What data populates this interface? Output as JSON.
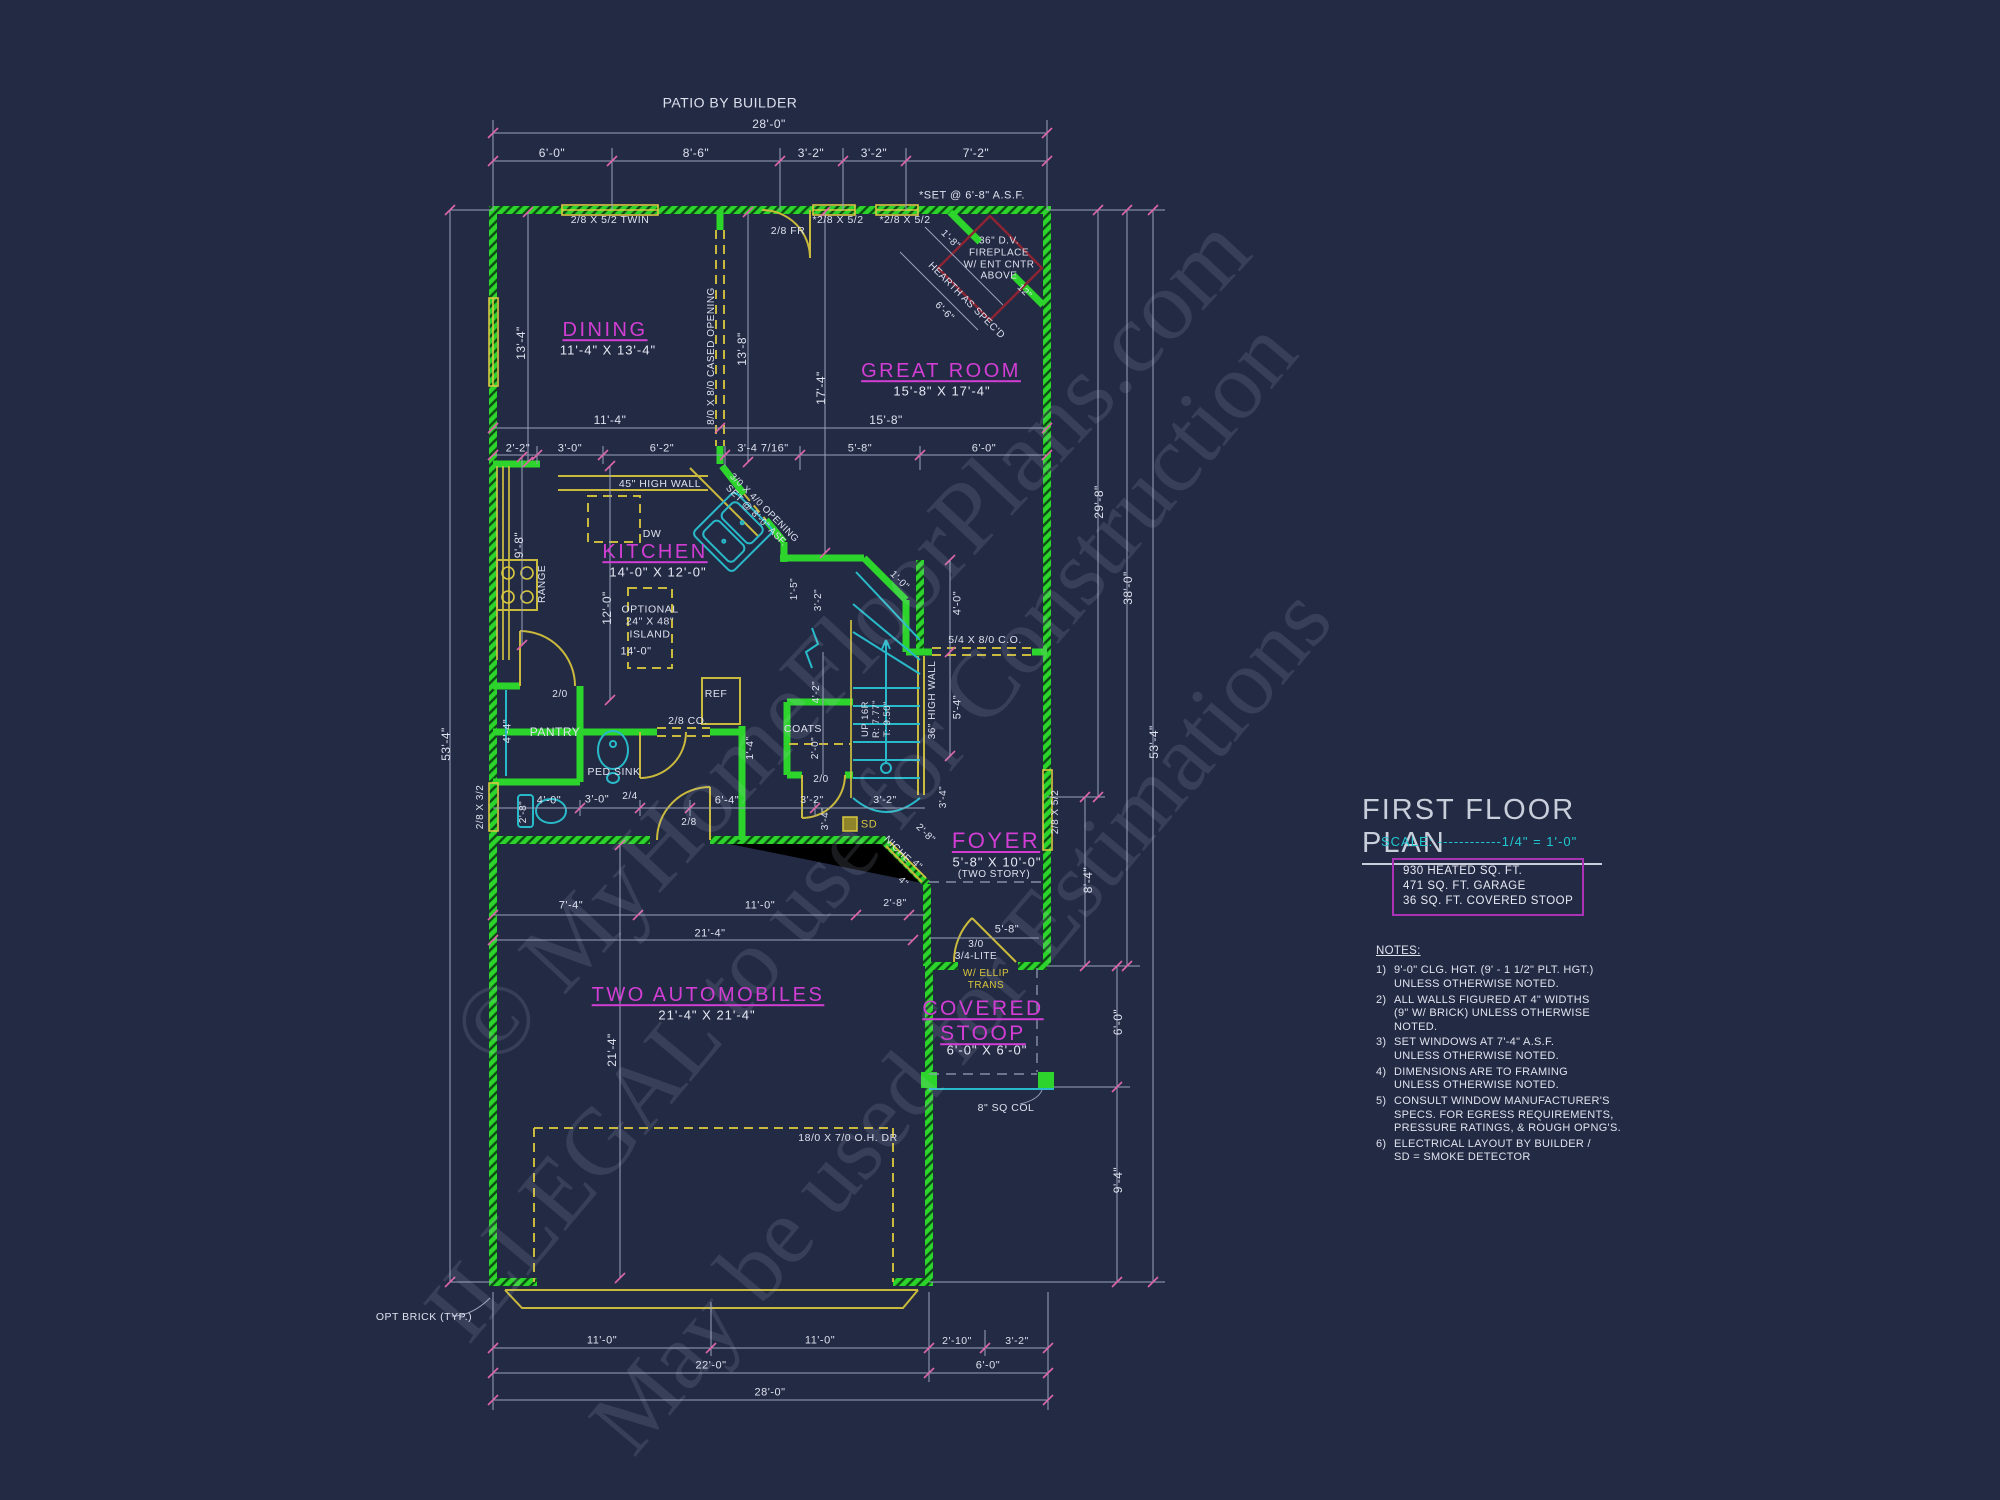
{
  "title_block": {
    "title": "FIRST FLOOR PLAN",
    "scale_text": "SCALE: ------------1/4\" = 1'-0\"",
    "area_lines": [
      "930 HEATED SQ. FT.",
      "471 SQ. FT. GARAGE",
      "36 SQ. FT. COVERED STOOP"
    ]
  },
  "notes": {
    "heading": "NOTES:",
    "items": [
      {
        "num": "1)",
        "text": "9'-0\"  CLG. HGT. (9' - 1 1/2\" PLT. HGT.)\nUNLESS OTHERWISE NOTED."
      },
      {
        "num": "2)",
        "text": "ALL  WALLS FIGURED AT 4\" WIDTHS\n(9\" W/ BRICK) UNLESS OTHERWISE NOTED."
      },
      {
        "num": "3)",
        "text": "SET WINDOWS AT 7'-4\" A.S.F.\nUNLESS OTHERWISE NOTED."
      },
      {
        "num": "4)",
        "text": "DIMENSIONS ARE TO FRAMING\nUNLESS OTHERWISE NOTED."
      },
      {
        "num": "5)",
        "text": "CONSULT WINDOW MANUFACTURER'S\nSPECS. FOR EGRESS REQUIREMENTS,\nPRESSURE RATINGS, & ROUGH OPNG'S."
      },
      {
        "num": "6)",
        "text": "ELECTRICAL LAYOUT BY BUILDER /\nSD = SMOKE DETECTOR"
      }
    ]
  },
  "watermark": {
    "lines": [
      {
        "t": "© MyHomeFloorPlans.com",
        "x": 850,
        "y": 640,
        "r": -47,
        "fs": 100
      },
      {
        "t": "ILLEGAL to use for Construction",
        "x": 860,
        "y": 830,
        "r": -50,
        "fs": 95
      },
      {
        "t": "May be used for Estimations",
        "x": 960,
        "y": 1020,
        "r": -50,
        "fs": 95
      }
    ]
  },
  "colors": {
    "background": "#232a44",
    "walls": "#2cd42c",
    "millwork": "#c9b93c",
    "fixtures": "#29bac9",
    "rooms": "#d23ed4",
    "dims": "#dde1ee",
    "ticks": "#de66a6",
    "scale": "#1fc9d2",
    "area_box_border": "#ab32b5",
    "fireplace": "#8c2433"
  },
  "plan": {
    "labels": [
      {
        "t": "PATIO BY BUILDER",
        "x": 730,
        "y": 103,
        "c": "dim",
        "fs": 14
      },
      {
        "t": "28'-0\"",
        "x": 769,
        "y": 124,
        "c": "dim"
      },
      {
        "t": "6'-0\"",
        "x": 552,
        "y": 153,
        "c": "dim"
      },
      {
        "t": "8'-6\"",
        "x": 696,
        "y": 153,
        "c": "dim"
      },
      {
        "t": "3'-2\"",
        "x": 811,
        "y": 153,
        "c": "dim"
      },
      {
        "t": "3'-2\"",
        "x": 874,
        "y": 153,
        "c": "dim"
      },
      {
        "t": "7'-2\"",
        "x": 976,
        "y": 153,
        "c": "dim"
      },
      {
        "t": "*SET @ 6'-8\" A.S.F.",
        "x": 972,
        "y": 196,
        "c": "dim",
        "fs": 11
      },
      {
        "t": "2/8 X 5/2 TWIN",
        "x": 610,
        "y": 220,
        "c": "dim",
        "fs": 10.5
      },
      {
        "t": "*2/8 X 5/2",
        "x": 838,
        "y": 220,
        "c": "dim",
        "fs": 10.5
      },
      {
        "t": "*2/8 X 5/2",
        "x": 905,
        "y": 220,
        "c": "dim",
        "fs": 10.5
      },
      {
        "t": "2/8 FR",
        "x": 788,
        "y": 231,
        "c": "dim",
        "fs": 10.5
      },
      {
        "t": "DINING",
        "x": 605,
        "y": 331,
        "c": "room"
      },
      {
        "t": "11'-4\" X 13'-4\"",
        "x": 608,
        "y": 350,
        "c": "rdim"
      },
      {
        "t": "GREAT ROOM",
        "x": 941,
        "y": 372,
        "c": "room"
      },
      {
        "t": "15'-8\" X 17'-4\"",
        "x": 942,
        "y": 391,
        "c": "rdim"
      },
      {
        "t": "13'-4\"",
        "x": 521,
        "y": 343,
        "r": -90,
        "c": "dim"
      },
      {
        "t": "8/0 X 8/0 CASED OPENING",
        "x": 712,
        "y": 356,
        "r": -90,
        "c": "dim",
        "fs": 10
      },
      {
        "t": "13'-8\"",
        "x": 742,
        "y": 349,
        "r": -90,
        "c": "dim"
      },
      {
        "t": "17'-4\"",
        "x": 821,
        "y": 388,
        "r": -90,
        "c": "dim"
      },
      {
        "t": "11'-4\"",
        "x": 610,
        "y": 420,
        "c": "dim"
      },
      {
        "t": "15'-8\"",
        "x": 886,
        "y": 420,
        "c": "dim"
      },
      {
        "t": "36\" D.V.\nFIREPLACE\nW/ ENT CNTR\nABOVE",
        "x": 999,
        "y": 259,
        "c": "dim",
        "fs": 10
      },
      {
        "t": "HEARTH AS SPEC'D",
        "x": 966,
        "y": 301,
        "r": 45,
        "c": "dim",
        "fs": 10
      },
      {
        "t": "6'-6\"",
        "x": 944,
        "y": 312,
        "r": 45,
        "c": "dim",
        "fs": 10
      },
      {
        "t": "1'-8\"",
        "x": 950,
        "y": 240,
        "r": 45,
        "c": "dim",
        "fs": 10
      },
      {
        "t": "12\"",
        "x": 1024,
        "y": 292,
        "r": 45,
        "c": "dim",
        "fs": 10
      },
      {
        "t": "2'-2\"",
        "x": 518,
        "y": 449,
        "c": "dim",
        "fs": 11
      },
      {
        "t": "3'-0\"",
        "x": 570,
        "y": 449,
        "c": "dim",
        "fs": 11
      },
      {
        "t": "6'-2\"",
        "x": 662,
        "y": 449,
        "c": "dim",
        "fs": 11
      },
      {
        "t": "3'-4 7/16\"",
        "x": 763,
        "y": 449,
        "c": "dim",
        "fs": 11
      },
      {
        "t": "5'-8\"",
        "x": 860,
        "y": 449,
        "c": "dim",
        "fs": 11
      },
      {
        "t": "6'-0\"",
        "x": 984,
        "y": 449,
        "c": "dim",
        "fs": 11
      },
      {
        "t": "45\" HIGH WALL",
        "x": 660,
        "y": 484,
        "c": "dim",
        "fs": 10.5
      },
      {
        "t": "KITCHEN",
        "x": 655,
        "y": 553,
        "c": "room"
      },
      {
        "t": "14'-0\" X 12'-0\"",
        "x": 658,
        "y": 572,
        "c": "rdim"
      },
      {
        "t": "DW",
        "x": 652,
        "y": 534,
        "c": "dim",
        "fs": 10.5
      },
      {
        "t": "3/0 X 4/0 OPENING\nSET @ 8'-0\" ASF.",
        "x": 760,
        "y": 512,
        "r": 45,
        "c": "dim",
        "fs": 9.5
      },
      {
        "t": "OPTIONAL\n24\" X 48\"\nISLAND",
        "x": 650,
        "y": 622,
        "c": "dim",
        "fs": 10.5
      },
      {
        "t": "14'-0\"",
        "x": 636,
        "y": 652,
        "c": "dim",
        "fs": 11
      },
      {
        "t": "12'-0\"",
        "x": 607,
        "y": 608,
        "r": -90,
        "c": "dim"
      },
      {
        "t": "9'-8\"",
        "x": 519,
        "y": 545,
        "r": -90,
        "c": "dim"
      },
      {
        "t": "RANGE",
        "x": 543,
        "y": 584,
        "r": -90,
        "c": "dim",
        "fs": 10
      },
      {
        "t": "REF",
        "x": 716,
        "y": 694,
        "c": "dim",
        "fs": 10.5
      },
      {
        "t": "2/0",
        "x": 560,
        "y": 695,
        "c": "dim",
        "fs": 10
      },
      {
        "t": "PANTRY",
        "x": 555,
        "y": 732,
        "c": "dim",
        "fs": 12
      },
      {
        "t": "4'-4\"",
        "x": 508,
        "y": 731,
        "r": -90,
        "c": "dim",
        "fs": 11
      },
      {
        "t": "PED SINK",
        "x": 614,
        "y": 772,
        "c": "dim",
        "fs": 10.5
      },
      {
        "t": "2/8 CO.",
        "x": 688,
        "y": 721,
        "c": "dim",
        "fs": 10.5
      },
      {
        "t": "1'-4\"",
        "x": 750,
        "y": 748,
        "r": -90,
        "c": "dim",
        "fs": 10.5
      },
      {
        "t": "2'-8\"",
        "x": 524,
        "y": 812,
        "r": -90,
        "c": "dim",
        "fs": 10
      },
      {
        "t": "4'-0\"",
        "x": 549,
        "y": 801,
        "c": "dim",
        "fs": 11
      },
      {
        "t": "3'-0\"",
        "x": 597,
        "y": 800,
        "c": "dim",
        "fs": 11
      },
      {
        "t": "2/4",
        "x": 630,
        "y": 797,
        "c": "dim",
        "fs": 10
      },
      {
        "t": "6'-4\"",
        "x": 727,
        "y": 801,
        "c": "dim",
        "fs": 11
      },
      {
        "t": "2/8",
        "x": 689,
        "y": 823,
        "c": "dim",
        "fs": 10
      },
      {
        "t": "2/8 X 3/2",
        "x": 481,
        "y": 807,
        "r": -90,
        "c": "dim",
        "fs": 10
      },
      {
        "t": "53'-4\"",
        "x": 446,
        "y": 744,
        "r": -90,
        "c": "dim"
      },
      {
        "t": "1'-5\"",
        "x": 795,
        "y": 589,
        "r": -90,
        "c": "dim",
        "fs": 10
      },
      {
        "t": "3'-2\"",
        "x": 819,
        "y": 600,
        "r": -90,
        "c": "dim",
        "fs": 10
      },
      {
        "t": "1'-0\"",
        "x": 899,
        "y": 581,
        "r": 45,
        "c": "dim",
        "fs": 10
      },
      {
        "t": "4'-0\"",
        "x": 958,
        "y": 603,
        "r": -90,
        "c": "dim",
        "fs": 11
      },
      {
        "t": "5/4 X 8/0 C.O.",
        "x": 985,
        "y": 640,
        "c": "dim",
        "fs": 10.5
      },
      {
        "t": "36\" HIGH WALL",
        "x": 933,
        "y": 700,
        "r": -90,
        "c": "dim",
        "fs": 10
      },
      {
        "t": "5'-4\"",
        "x": 958,
        "y": 707,
        "r": -90,
        "c": "dim",
        "fs": 11
      },
      {
        "t": "UP 16R\nR: 7.77\"\nT: 9.50\"",
        "x": 877,
        "y": 719,
        "r": -90,
        "c": "dim",
        "fs": 9.5
      },
      {
        "t": "4'-2\"",
        "x": 817,
        "y": 692,
        "r": -90,
        "c": "dim",
        "fs": 10
      },
      {
        "t": "COATS",
        "x": 803,
        "y": 729,
        "c": "dim",
        "fs": 10.5
      },
      {
        "t": "2'-0\"",
        "x": 816,
        "y": 748,
        "r": -90,
        "c": "dim",
        "fs": 10
      },
      {
        "t": "2/0",
        "x": 821,
        "y": 780,
        "c": "dim",
        "fs": 10
      },
      {
        "t": "29'-8\"",
        "x": 1099,
        "y": 502,
        "r": -90,
        "c": "dim"
      },
      {
        "t": "38'-0\"",
        "x": 1128,
        "y": 588,
        "r": -90,
        "c": "dim"
      },
      {
        "t": "53'-4\"",
        "x": 1154,
        "y": 742,
        "r": -90,
        "c": "dim"
      },
      {
        "t": "3'-2\"",
        "x": 812,
        "y": 800,
        "c": "dim",
        "fs": 10.5
      },
      {
        "t": "3'-2\"",
        "x": 885,
        "y": 800,
        "c": "dim",
        "fs": 10.5
      },
      {
        "t": "3'-4\"",
        "x": 826,
        "y": 819,
        "r": -90,
        "c": "dim",
        "fs": 10
      },
      {
        "t": "3'-4\"",
        "x": 944,
        "y": 797,
        "r": -90,
        "c": "dim",
        "fs": 10
      },
      {
        "t": "SD",
        "x": 869,
        "y": 825,
        "c": "yel",
        "fs": 11
      },
      {
        "t": "NICHE",
        "x": 897,
        "y": 850,
        "r": 45,
        "c": "dim",
        "fs": 10
      },
      {
        "t": "2'-8\"",
        "x": 925,
        "y": 834,
        "r": 45,
        "c": "dim",
        "fs": 10
      },
      {
        "t": "4\"",
        "x": 917,
        "y": 865,
        "r": 45,
        "c": "dim",
        "fs": 9.5
      },
      {
        "t": "4\"",
        "x": 903,
        "y": 882,
        "r": 45,
        "c": "dim",
        "fs": 9.5
      },
      {
        "t": "2'-8\"",
        "x": 895,
        "y": 903,
        "c": "dim",
        "fs": 10.5
      },
      {
        "t": "FOYER",
        "x": 996,
        "y": 841,
        "c": "room",
        "fs": 22
      },
      {
        "t": "5'-8\" X 10'-0\"",
        "x": 997,
        "y": 862,
        "c": "rdim"
      },
      {
        "t": "(TWO STORY)",
        "x": 994,
        "y": 875,
        "c": "dim",
        "fs": 10
      },
      {
        "t": "8'-4\"",
        "x": 1088,
        "y": 880,
        "r": -90,
        "c": "dim"
      },
      {
        "t": "5'-8\"",
        "x": 1007,
        "y": 930,
        "c": "dim",
        "fs": 11
      },
      {
        "t": "3/0\n3/4-LITE",
        "x": 976,
        "y": 951,
        "c": "dim",
        "fs": 10
      },
      {
        "t": "W/ ELLIP\nTRANS",
        "x": 986,
        "y": 980,
        "c": "yel",
        "fs": 10
      },
      {
        "t": "7'-4\"",
        "x": 571,
        "y": 906,
        "c": "dim",
        "fs": 11
      },
      {
        "t": "11'-0\"",
        "x": 760,
        "y": 906,
        "c": "dim",
        "fs": 11
      },
      {
        "t": "21'-4\"",
        "x": 710,
        "y": 934,
        "c": "dim",
        "fs": 11
      },
      {
        "t": "TWO AUTOMOBILES",
        "x": 708,
        "y": 996,
        "c": "room"
      },
      {
        "t": "21'-4\" X 21'-4\"",
        "x": 707,
        "y": 1015,
        "c": "rdim"
      },
      {
        "t": "21'-4\"",
        "x": 612,
        "y": 1050,
        "r": -90,
        "c": "dim"
      },
      {
        "t": "COVERED\nSTOOP",
        "x": 983,
        "y": 1022,
        "c": "room",
        "fs": 21
      },
      {
        "t": "6'-0\" X 6'-0\"",
        "x": 987,
        "y": 1050,
        "c": "rdim"
      },
      {
        "t": "6'-0\"",
        "x": 1118,
        "y": 1022,
        "r": -90,
        "c": "dim"
      },
      {
        "t": "8\" SQ COL",
        "x": 1006,
        "y": 1108,
        "c": "dim",
        "fs": 10.5
      },
      {
        "t": "18/0 X 7/0 O.H. DR",
        "x": 848,
        "y": 1138,
        "c": "dim",
        "fs": 10.5
      },
      {
        "t": "9'-4\"",
        "x": 1118,
        "y": 1180,
        "r": -90,
        "c": "dim"
      },
      {
        "t": "OPT BRICK (TYP.)",
        "x": 424,
        "y": 1317,
        "c": "dim",
        "fs": 10.5
      },
      {
        "t": "11'-0\"",
        "x": 602,
        "y": 1341,
        "c": "dim",
        "fs": 11
      },
      {
        "t": "11'-0\"",
        "x": 820,
        "y": 1341,
        "c": "dim",
        "fs": 11
      },
      {
        "t": "2'-10\"",
        "x": 957,
        "y": 1341,
        "c": "dim",
        "fs": 10.5
      },
      {
        "t": "3'-2\"",
        "x": 1017,
        "y": 1341,
        "c": "dim",
        "fs": 10.5
      },
      {
        "t": "22'-0\"",
        "x": 711,
        "y": 1366,
        "c": "dim",
        "fs": 11
      },
      {
        "t": "6'-0\"",
        "x": 988,
        "y": 1366,
        "c": "dim",
        "fs": 11
      },
      {
        "t": "28'-0\"",
        "x": 770,
        "y": 1393,
        "c": "dim",
        "fs": 11
      },
      {
        "t": "2/8 X 5/2",
        "x": 1056,
        "y": 812,
        "r": -90,
        "c": "dim",
        "fs": 10
      }
    ]
  }
}
